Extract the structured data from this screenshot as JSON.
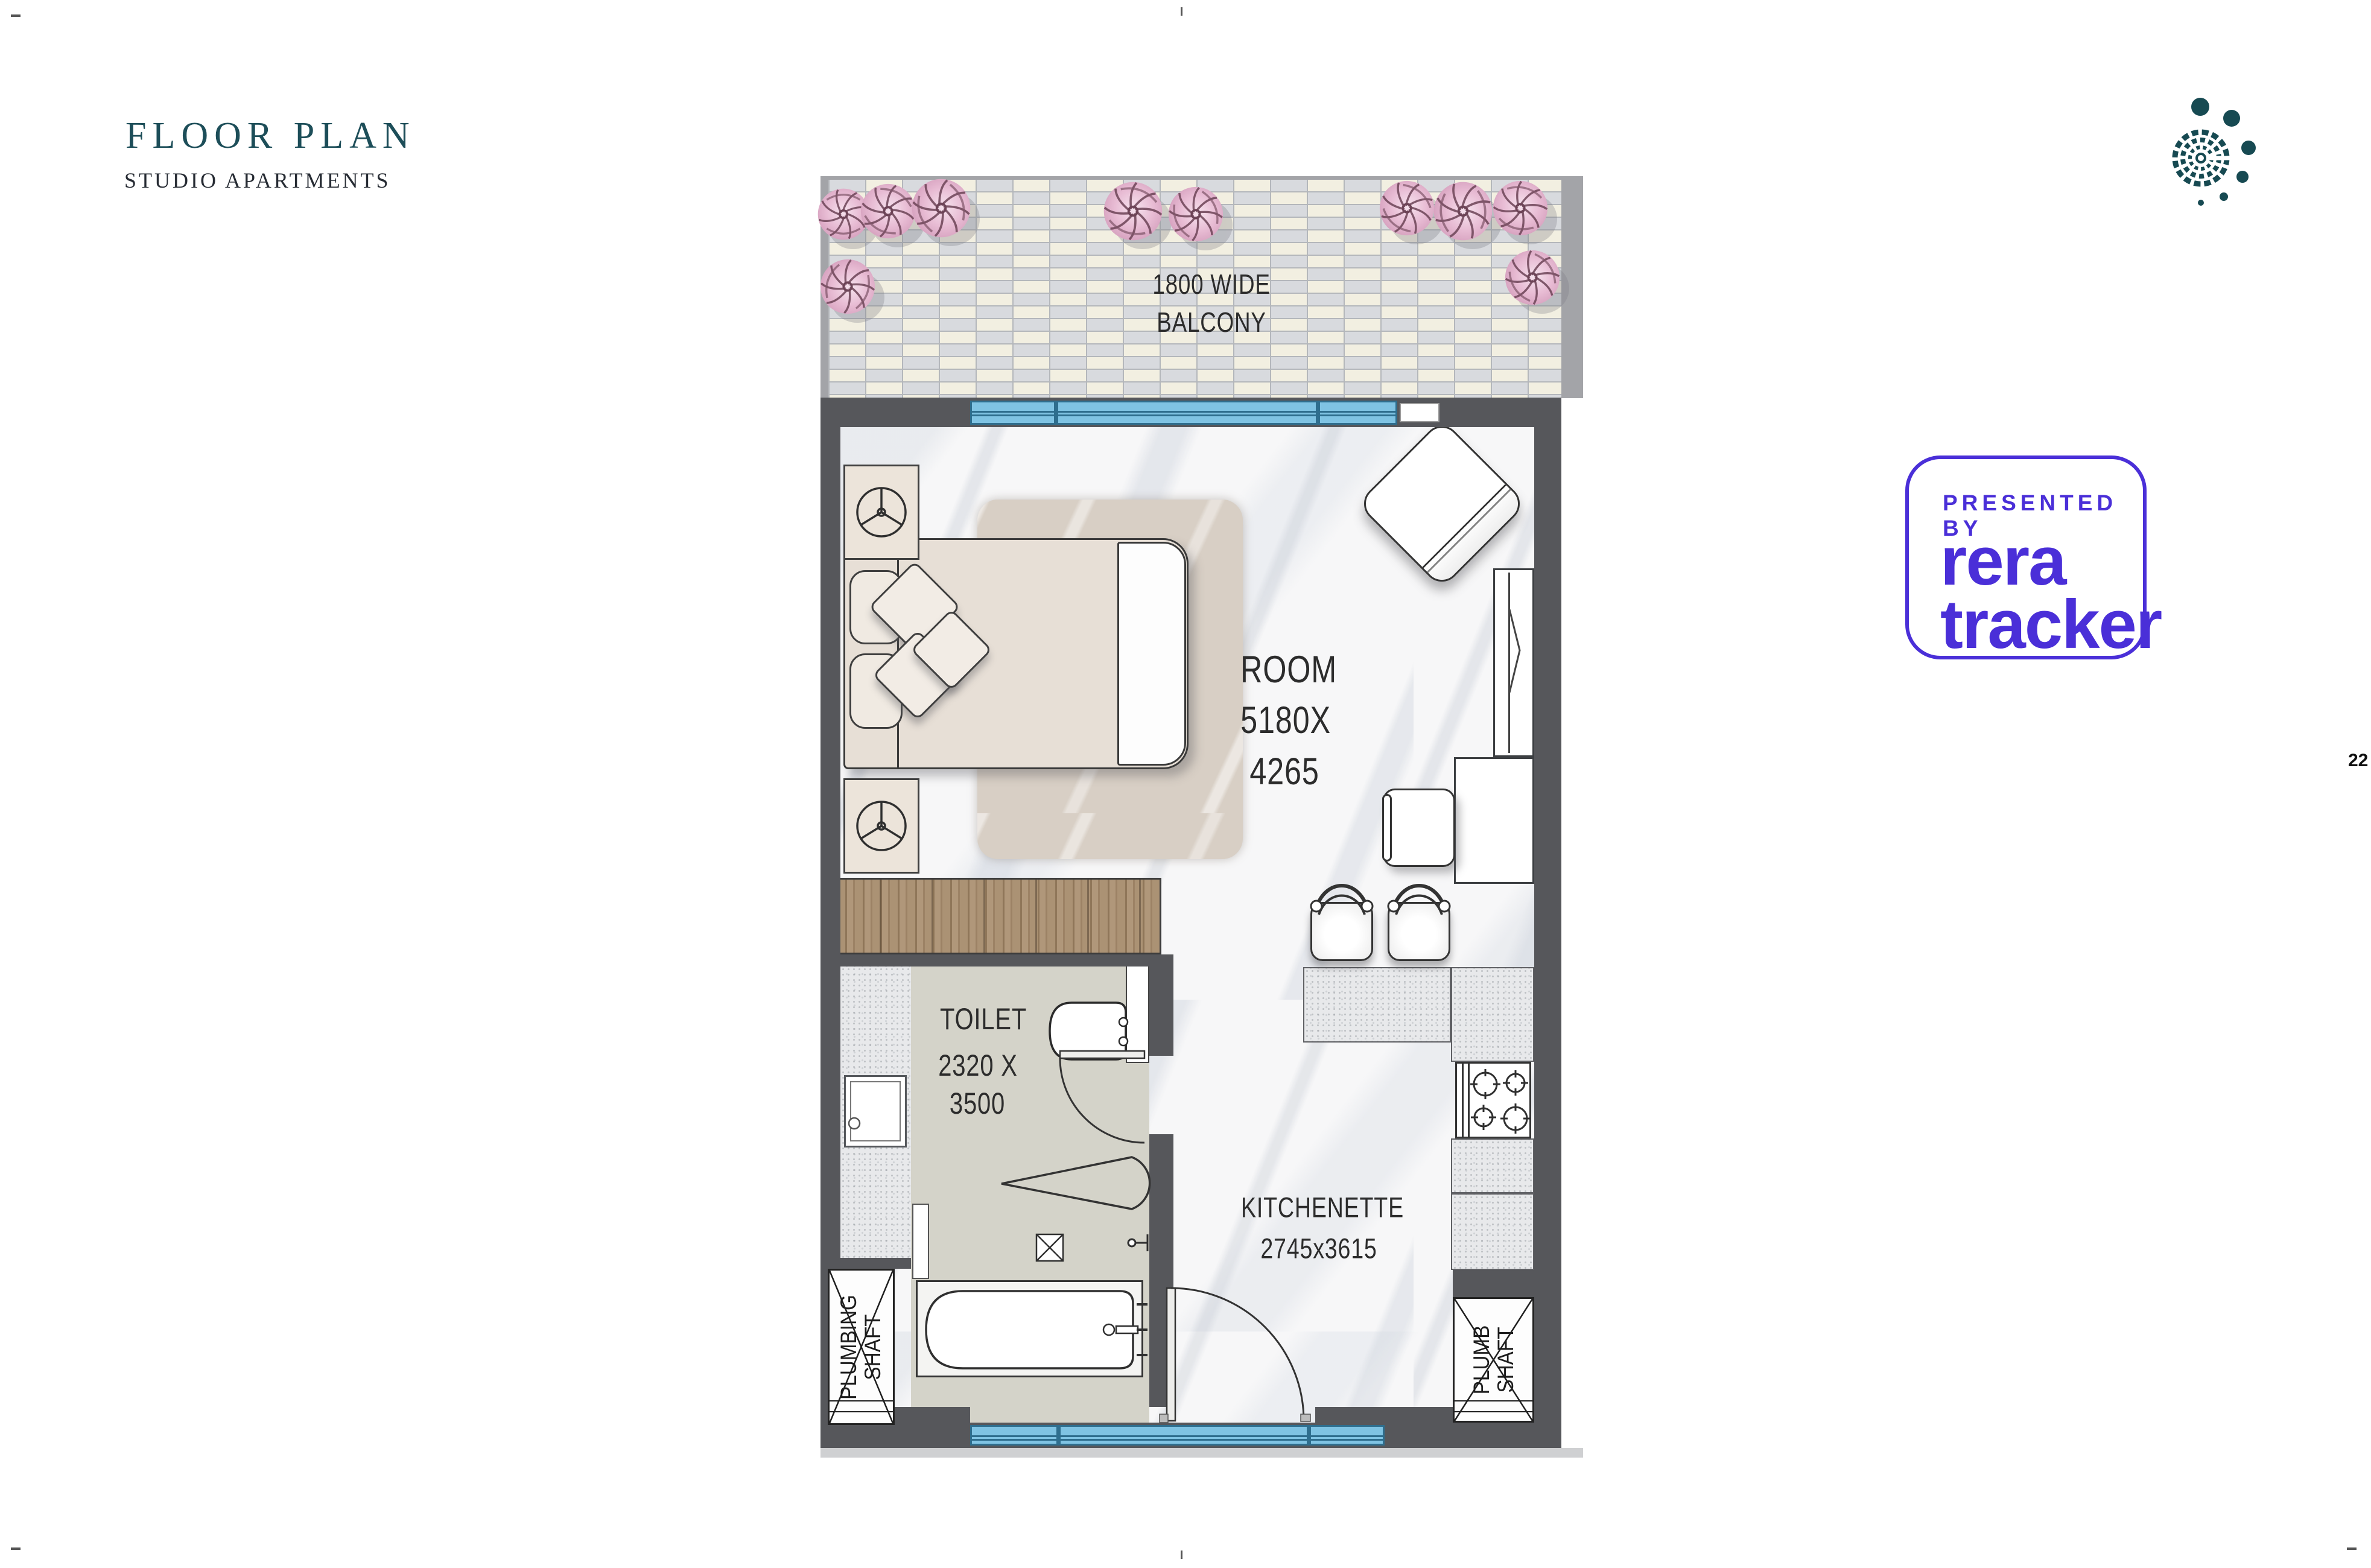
{
  "page": {
    "title": "FLOOR PLAN",
    "subtitle": "STUDIO APARTMENTS",
    "page_number": "22"
  },
  "badge": {
    "presented_by": "PRESENTED BY",
    "brand_line1": "rera",
    "brand_line2": "tracker",
    "accent_color": "#4a2fd8"
  },
  "logo": {
    "name": "mandala-dots-logo",
    "color": "#174a52"
  },
  "plan": {
    "balcony": {
      "line1": "1800 WIDE",
      "line2": "BALCONY"
    },
    "room": {
      "line1": "ROOM",
      "line2": "5180X",
      "line3": "4265"
    },
    "toilet": {
      "line1": "TOILET",
      "line2": "2320 X",
      "line3": "3500"
    },
    "kitchenette": {
      "line1": "KITCHENETTE",
      "line2": "2745x3615"
    },
    "plumbing_shaft": {
      "line1": "PLUMBING",
      "line2": "SHAFT"
    },
    "plumb_shaft": {
      "line1": "PLUMB",
      "line2": "SHAFT"
    },
    "colors": {
      "wall": "#56575b",
      "balcony_tile_a": "#f2efe1",
      "balcony_tile_b": "#d8dade",
      "window_blue": "#7fc3e3",
      "window_frame": "#2e6e8e",
      "wood": "#a8906f",
      "toilet_floor": "#d4d3c9",
      "bed": "#e7dfd6",
      "rug": "#d8cfc5",
      "flower_pink": "#e8bcd4"
    },
    "icons": [
      "flower-icon",
      "fan-icon",
      "burner-icon",
      "shower-icon",
      "drain-icon",
      "door-arc-icon",
      "shaft-cross-icon"
    ]
  }
}
